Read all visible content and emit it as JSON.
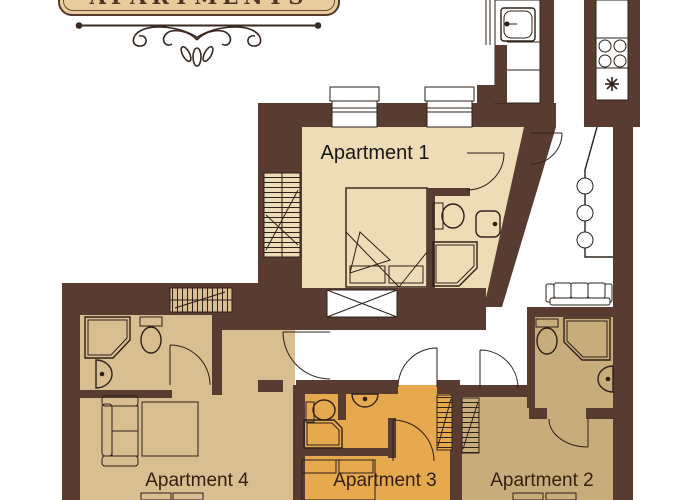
{
  "header": {
    "plaque_text": "APARTMENTS"
  },
  "floor_plan": {
    "apartments": [
      {
        "label": "Apartment 1",
        "floor_color": "#eedcb6"
      },
      {
        "label": "Apartment 2",
        "floor_color": "#c9ac7c"
      },
      {
        "label": "Apartment 3",
        "floor_color": "#e7a94e"
      },
      {
        "label": "Apartment 4",
        "floor_color": "#d9be92"
      }
    ],
    "wall_color": "#583c31",
    "line_color": "#2e2019",
    "fixture_icons": [
      "bed",
      "sofa",
      "toilet",
      "sink",
      "shower",
      "stove-burners",
      "kitchen-sink",
      "radiator",
      "wardrobe-x-box",
      "bar-stools",
      "door-arc",
      "window",
      "defrost-star"
    ]
  }
}
